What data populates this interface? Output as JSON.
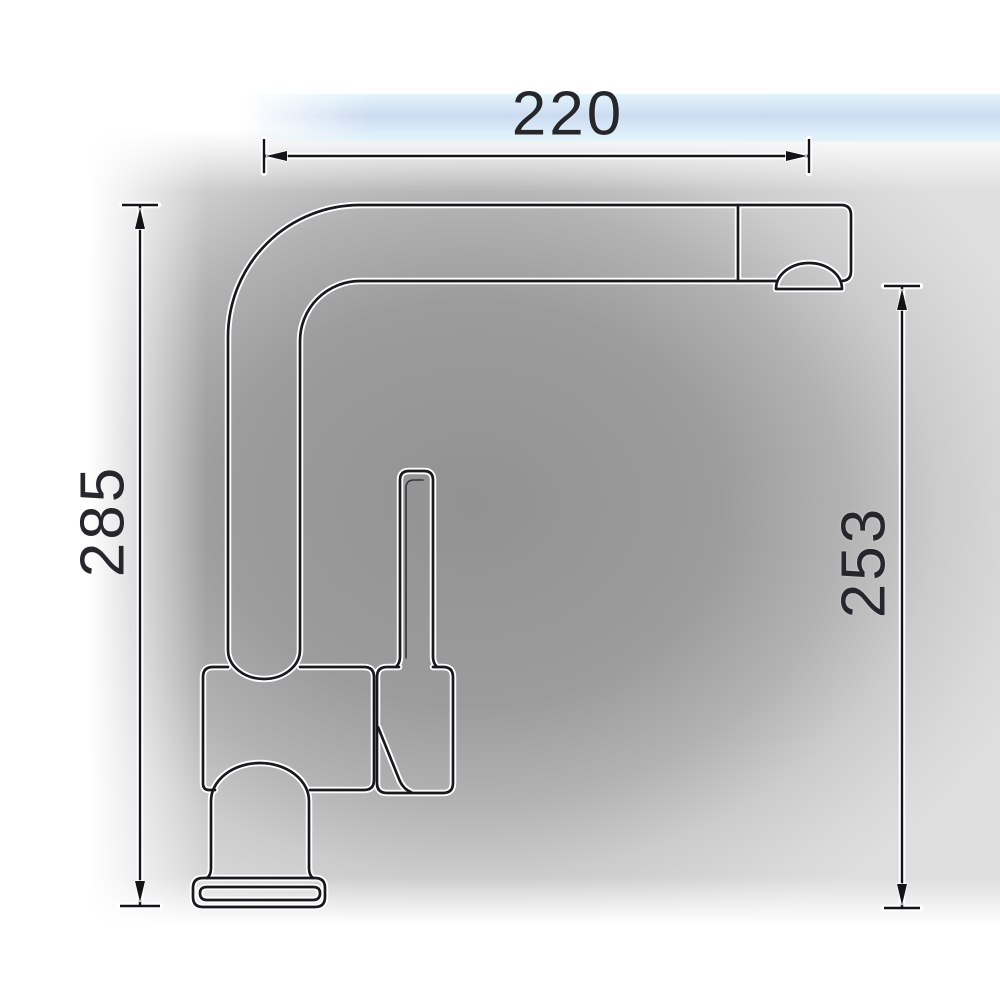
{
  "diagram": {
    "subject": "Single-lever kitchen faucet side-profile technical dimension drawing",
    "labels": {
      "top_width": "220",
      "left_height": "285",
      "right_height": "253"
    }
  },
  "parts": [
    "spout-tube",
    "spray-head",
    "aerator-dome",
    "lever-stick",
    "valve-body",
    "handle-housing",
    "mounting-column",
    "base-plate"
  ],
  "colors": {
    "ink": "#18181d",
    "label_text": "#26262d",
    "background_center": "#9a9a9a",
    "background_right_edge": "#dadada",
    "background_outer": "#ffffff",
    "artifact_band_blue": "#cfe0f2"
  }
}
